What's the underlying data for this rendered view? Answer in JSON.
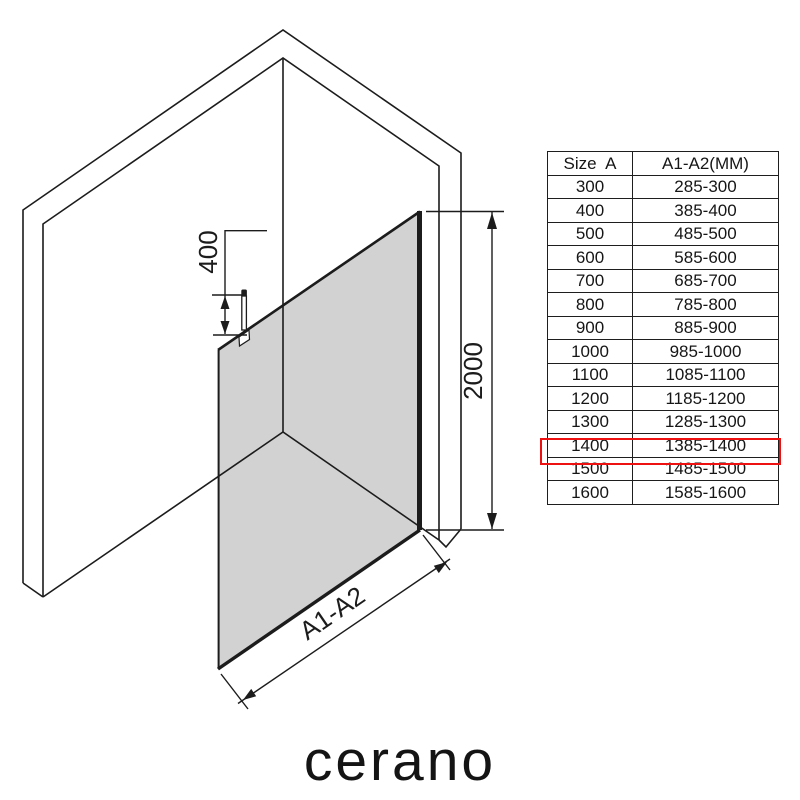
{
  "brand": {
    "logo_text": "cerano"
  },
  "diagram": {
    "description": "isometric walk-in shower glass panel between two walls",
    "glass_color": "#d2d2d2",
    "line_color": "#1c1c1c",
    "dimensions": {
      "support_bar": {
        "label": "400"
      },
      "height": {
        "label": "2000"
      },
      "width": {
        "label": "A1-A2"
      }
    }
  },
  "size_table": {
    "headers": {
      "size": "Size  A",
      "range": "A1-A2(MM)"
    },
    "highlight_color": "#ee1111",
    "rows": [
      {
        "size": "300",
        "range": "285-300",
        "highlighted": false
      },
      {
        "size": "400",
        "range": "385-400",
        "highlighted": false
      },
      {
        "size": "500",
        "range": "485-500",
        "highlighted": false
      },
      {
        "size": "600",
        "range": "585-600",
        "highlighted": false
      },
      {
        "size": "700",
        "range": "685-700",
        "highlighted": false
      },
      {
        "size": "800",
        "range": "785-800",
        "highlighted": false
      },
      {
        "size": "900",
        "range": "885-900",
        "highlighted": false
      },
      {
        "size": "1000",
        "range": "985-1000",
        "highlighted": false
      },
      {
        "size": "1100",
        "range": "1085-1100",
        "highlighted": false
      },
      {
        "size": "1200",
        "range": "1185-1200",
        "highlighted": false
      },
      {
        "size": "1300",
        "range": "1285-1300",
        "highlighted": false
      },
      {
        "size": "1400",
        "range": "1385-1400",
        "highlighted": true
      },
      {
        "size": "1500",
        "range": "1485-1500",
        "highlighted": false
      },
      {
        "size": "1600",
        "range": "1585-1600",
        "highlighted": false
      }
    ]
  }
}
